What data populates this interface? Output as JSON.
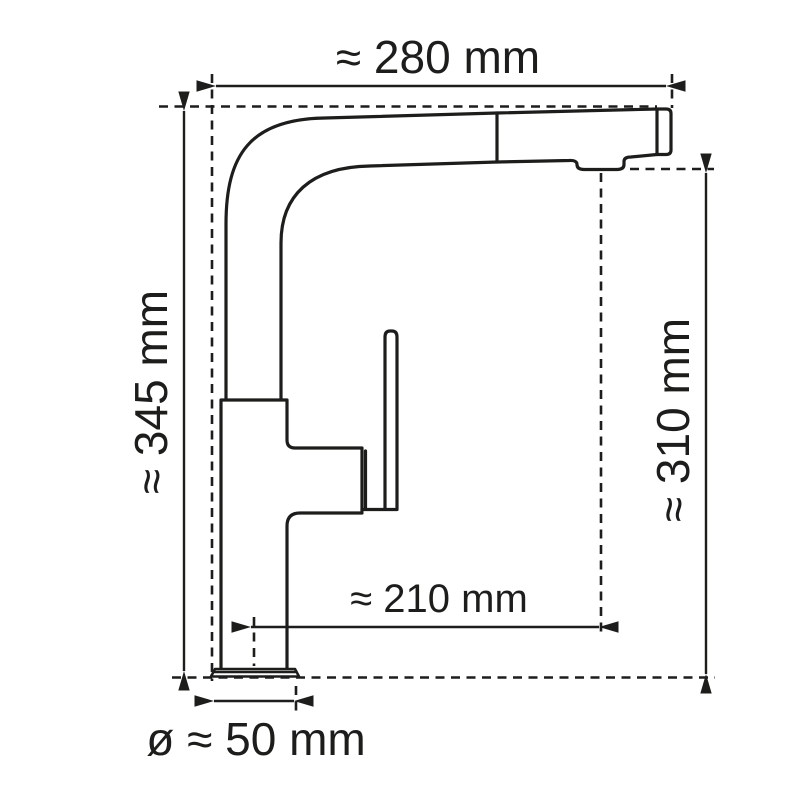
{
  "diagram": {
    "subject": "kitchen-faucet-dimension-drawing",
    "colors": {
      "line": "#1d1d1b",
      "background": "#ffffff"
    },
    "unit": "mm",
    "dimensions": {
      "spout_width": {
        "label": "≈ 280 mm",
        "value": 280,
        "unit": "mm"
      },
      "total_height": {
        "label": "≈ 345 mm",
        "value": 345,
        "unit": "mm"
      },
      "outlet_height": {
        "label": "≈ 310 mm",
        "value": 310,
        "unit": "mm"
      },
      "outlet_reach": {
        "label": "≈ 210 mm",
        "value": 210,
        "unit": "mm"
      },
      "base_diameter": {
        "label": "ø ≈ 50 mm",
        "value": 50,
        "unit": "mm"
      }
    }
  }
}
